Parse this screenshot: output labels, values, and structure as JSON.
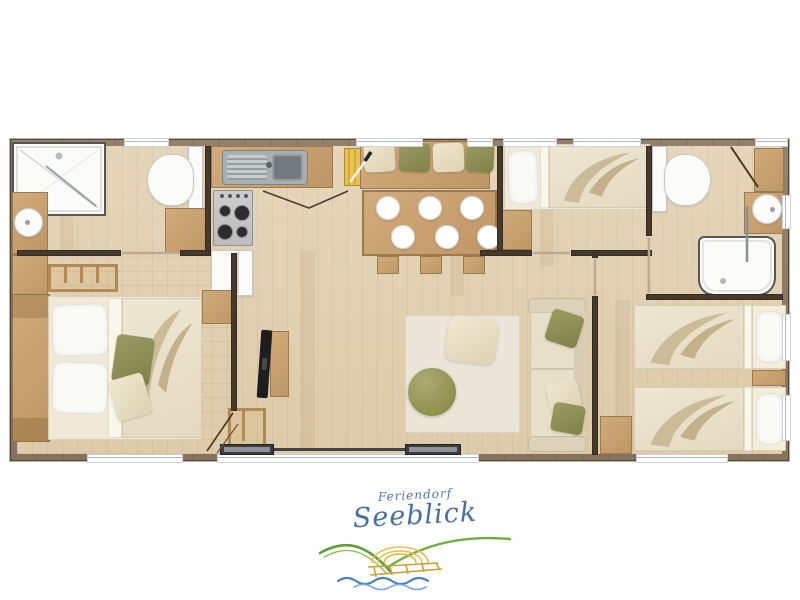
{
  "logo": {
    "line1": "Feriendorf",
    "line2": "Seeblick",
    "text_color": "#46709f",
    "hill_green": "#6fae3e",
    "hill_green_dark": "#4f8f34",
    "sun_yellow": "#e6bf4d",
    "pier_yellow": "#c99f3a",
    "wave_blue": "#4a7fc1",
    "wave_blue_light": "#7fa9d8"
  },
  "palette": {
    "outer_wall": "#8b7766",
    "inner_wall": "#463a2c",
    "floor_wood": "#e0cfb1",
    "cabinet_wood": "#c9a878",
    "fixture_white": "#fbfbf9",
    "steel_sink": "#a9afb1",
    "stove_gray": "#c6c6c6",
    "cushion_olive": "#8f9157",
    "cushion_cream": "#eae2cb",
    "bedding_cream": "#ece3cf",
    "rug": "#ebe5d9",
    "pouf_olive": "#9a9a60",
    "tv_black": "#1d1d1d"
  },
  "floorplan": {
    "type": "top-down holiday-home floor plan",
    "rooms": [
      {
        "name": "bathroom-left",
        "furniture": [
          "shower",
          "toilet",
          "round-basin",
          "vanity",
          "drawer-unit",
          "towel-shelf",
          "side-cabinet"
        ]
      },
      {
        "name": "bedroom-double",
        "furniture": [
          "double-bed",
          "two-white-pillows",
          "olive-cushion",
          "beige-cushion",
          "headboard-shelf",
          "wardrobe"
        ]
      },
      {
        "name": "kitchen",
        "furniture": [
          "worktop",
          "double-sink",
          "cutting-board-with-knife",
          "four-burner-hob",
          "fridge"
        ]
      },
      {
        "name": "dining",
        "furniture": [
          "bench-with-4-cushions",
          "dining-table",
          "6-plates",
          "3-stools"
        ]
      },
      {
        "name": "living",
        "furniture": [
          "tv",
          "tv-stand",
          "magazine-basket",
          "rug",
          "round-pouf",
          "square-pouf",
          "sofa-with-cushions",
          "sliding-glass-door"
        ]
      },
      {
        "name": "bedroom-single",
        "furniture": [
          "single-bed",
          "under-window-cabinet"
        ]
      },
      {
        "name": "bathroom-right",
        "furniture": [
          "toilet",
          "round-basin",
          "vanity",
          "wall-cabinet",
          "shower",
          "door-swing"
        ]
      },
      {
        "name": "bedroom-twin",
        "furniture": [
          "single-bed-top",
          "single-bed-bottom",
          "nightstand",
          "corner-cabinet"
        ]
      }
    ],
    "counts": {
      "plates": 6,
      "bench_cushions": 4,
      "stools": 3,
      "beds": 4,
      "showers": 2,
      "toilets": 2,
      "basins": 2
    }
  }
}
